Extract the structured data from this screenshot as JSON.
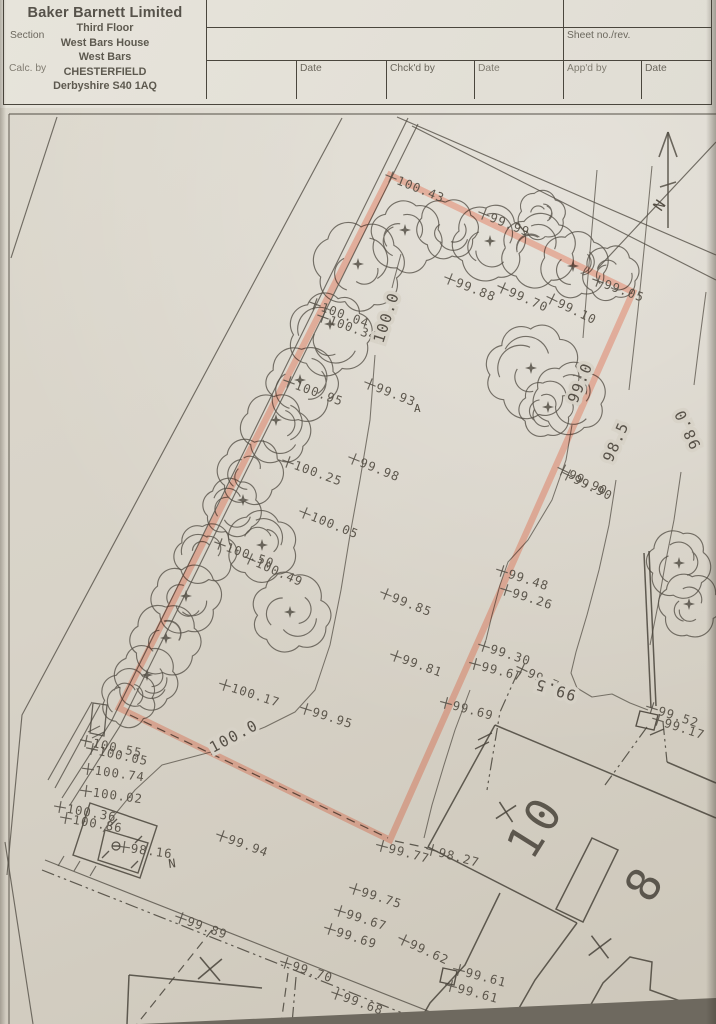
{
  "title_block": {
    "company": {
      "name": "Baker Barnett Limited",
      "address_lines": [
        "Third Floor",
        "West Bars House",
        "West Bars",
        "CHESTERFIELD",
        "Derbyshire S40 1AQ"
      ]
    },
    "fields": {
      "section": "Section",
      "sheet": "Sheet no./rev.",
      "calc_by": "Calc. by",
      "date1": "Date",
      "chckd_by": "Chck'd by",
      "date2": "Date",
      "appd_by": "App'd by",
      "date3": "Date"
    }
  },
  "drawing": {
    "colors": {
      "ink": "#555047",
      "plot_ink": "#49443b",
      "paper": "#d8d3c8",
      "boundary_pink": "#ffb9a6"
    },
    "north_arrow_label": "N",
    "annotations": [
      {
        "t": "A",
        "x": 414,
        "y": 412,
        "r": 0,
        "s": 11
      },
      {
        "t": "N",
        "x": 169,
        "y": 868,
        "r": -8,
        "s": 12
      },
      {
        "t": "N",
        "x": 661,
        "y": 212,
        "r": -55,
        "s": 15
      }
    ],
    "spot_levels": [
      {
        "t": "100.43",
        "x": 391,
        "y": 177,
        "r": 22
      },
      {
        "t": "99.99",
        "x": 484,
        "y": 214,
        "r": 22
      },
      {
        "t": "99.05",
        "x": 598,
        "y": 281,
        "r": 20
      },
      {
        "t": "99.88",
        "x": 450,
        "y": 279,
        "r": 22
      },
      {
        "t": "99.70",
        "x": 503,
        "y": 288,
        "r": 24
      },
      {
        "t": "99.10",
        "x": 552,
        "y": 299,
        "r": 26
      },
      {
        "t": "100.04",
        "x": 315,
        "y": 304,
        "r": 20
      },
      {
        "t": "100.34",
        "x": 323,
        "y": 317,
        "r": 20
      },
      {
        "t": "99.93",
        "x": 370,
        "y": 384,
        "r": 22
      },
      {
        "t": "100.95",
        "x": 289,
        "y": 382,
        "r": 20
      },
      {
        "t": "100.25",
        "x": 288,
        "y": 462,
        "r": 20
      },
      {
        "t": "99.98",
        "x": 354,
        "y": 459,
        "r": 22
      },
      {
        "t": "100.05",
        "x": 305,
        "y": 513,
        "r": 22
      },
      {
        "t": "100.50",
        "x": 220,
        "y": 544,
        "r": 20
      },
      {
        "t": "100.49",
        "x": 250,
        "y": 559,
        "r": 24
      },
      {
        "t": "99.90",
        "x": 563,
        "y": 470,
        "r": 26
      },
      {
        "t": "99.90",
        "x": 568,
        "y": 475,
        "r": 26
      },
      {
        "t": "99.85",
        "x": 386,
        "y": 594,
        "r": 22
      },
      {
        "t": "99.48",
        "x": 502,
        "y": 571,
        "r": 18
      },
      {
        "t": "99.26",
        "x": 506,
        "y": 590,
        "r": 18
      },
      {
        "t": "99.81",
        "x": 396,
        "y": 656,
        "r": 20
      },
      {
        "t": "99.30",
        "x": 484,
        "y": 646,
        "r": 18
      },
      {
        "t": "99.67",
        "x": 475,
        "y": 664,
        "r": 15
      },
      {
        "t": "99.78",
        "x": 522,
        "y": 669,
        "r": 25
      },
      {
        "t": "99.69",
        "x": 446,
        "y": 703,
        "r": 15
      },
      {
        "t": "99.52",
        "x": 652,
        "y": 708,
        "r": 18
      },
      {
        "t": "99.17",
        "x": 658,
        "y": 720,
        "r": 18
      },
      {
        "t": "100.17",
        "x": 225,
        "y": 685,
        "r": 18
      },
      {
        "t": "99.95",
        "x": 306,
        "y": 709,
        "r": 18
      },
      {
        "t": "100.55",
        "x": 86,
        "y": 741,
        "r": 12
      },
      {
        "t": "100.05",
        "x": 92,
        "y": 749,
        "r": 12
      },
      {
        "t": "100.74",
        "x": 88,
        "y": 769,
        "r": 8
      },
      {
        "t": "100.02",
        "x": 86,
        "y": 791,
        "r": 8
      },
      {
        "t": "100.36",
        "x": 60,
        "y": 807,
        "r": 10
      },
      {
        "t": "100.86",
        "x": 66,
        "y": 818,
        "r": 10
      },
      {
        "t": "98.16",
        "x": 124,
        "y": 847,
        "r": 8
      },
      {
        "t": "99.94",
        "x": 222,
        "y": 836,
        "r": 20
      },
      {
        "t": "99.77",
        "x": 382,
        "y": 846,
        "r": 15
      },
      {
        "t": "98.27",
        "x": 432,
        "y": 850,
        "r": 15
      },
      {
        "t": "99.75",
        "x": 355,
        "y": 889,
        "r": 18
      },
      {
        "t": "99.67",
        "x": 340,
        "y": 911,
        "r": 18
      },
      {
        "t": "99.69",
        "x": 330,
        "y": 929,
        "r": 18
      },
      {
        "t": "99.89",
        "x": 181,
        "y": 918,
        "r": 20
      },
      {
        "t": "99.70",
        "x": 286,
        "y": 963,
        "r": 18
      },
      {
        "t": "99.68",
        "x": 337,
        "y": 994,
        "r": 20
      },
      {
        "t": "99.62",
        "x": 404,
        "y": 940,
        "r": 25
      },
      {
        "t": "99.61",
        "x": 459,
        "y": 970,
        "r": 15
      },
      {
        "t": "99.61",
        "x": 451,
        "y": 986,
        "r": 15
      }
    ],
    "contour_labels": [
      {
        "t": "100.0",
        "x": 383,
        "y": 344,
        "r": -72
      },
      {
        "t": "100.0",
        "x": 213,
        "y": 753,
        "r": -28
      },
      {
        "t": "99.0",
        "x": 577,
        "y": 404,
        "r": -68
      },
      {
        "t": "98.5",
        "x": 612,
        "y": 463,
        "r": -66
      },
      {
        "t": "98.0",
        "x": 701,
        "y": 446,
        "r": 245
      },
      {
        "t": "99.5",
        "x": 577,
        "y": 691,
        "r": 197
      }
    ],
    "plot_numbers": [
      {
        "t": "10",
        "x": 532,
        "y": 862,
        "r": -58
      },
      {
        "t": "8",
        "x": 650,
        "y": 905,
        "r": -58
      }
    ],
    "x_marks": [
      {
        "symbol": "×",
        "x": 506,
        "y": 812,
        "s": 17,
        "r": 12
      },
      {
        "symbol": "×",
        "x": 600,
        "y": 947,
        "s": 20,
        "r": 8
      },
      {
        "symbol": "×",
        "x": 210,
        "y": 969,
        "s": 22,
        "r": 5
      }
    ]
  }
}
